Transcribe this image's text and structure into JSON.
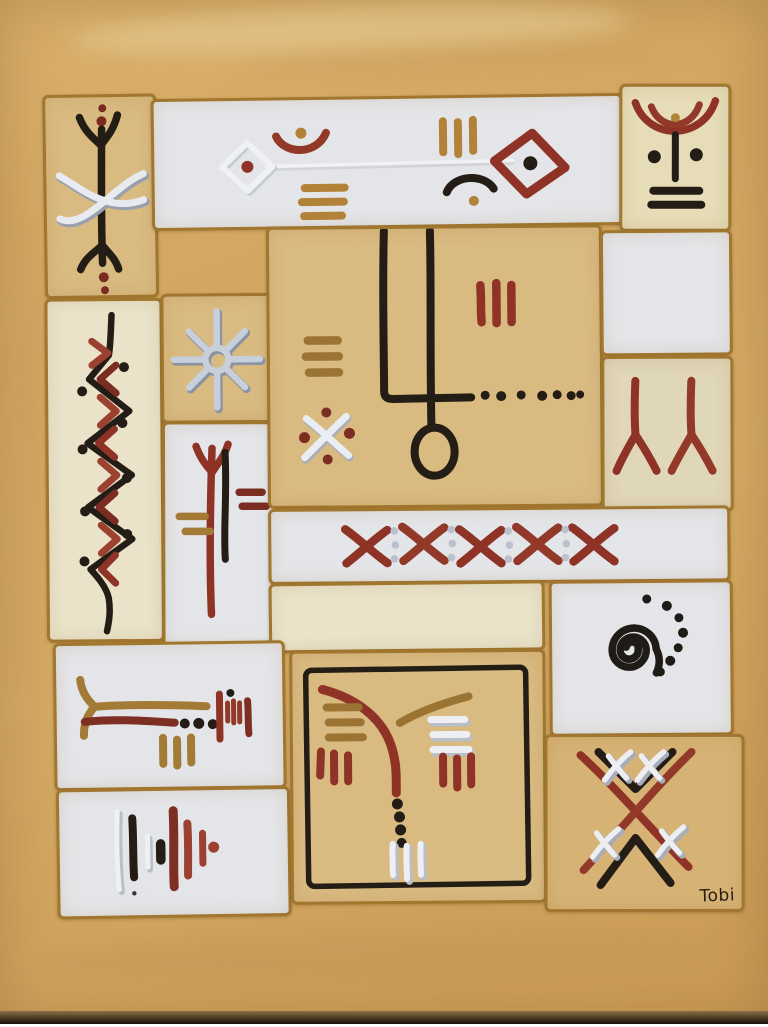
{
  "artwork": {
    "signature": "Tobi"
  },
  "palette": {
    "background_mustard": "#d3a761",
    "panel_tan": "#d9ba80",
    "panel_cream": "#eae3ca",
    "panel_cream_dark": "#e0d6b8",
    "panel_white": "#e4e5e8",
    "divider_ochre": "#a1762e",
    "symbol_black": "#241d16",
    "symbol_maroon": "#7c2d22",
    "symbol_red": "#8e3326",
    "symbol_ochre": "#a37a36",
    "symbol_silver": "#c3cad6",
    "symbol_white": "#eceef2"
  },
  "panels": [
    {
      "id": "top-left",
      "background": "tan",
      "symbols": [
        "dots-pair",
        "trident-up",
        "center-pole",
        "white-woven-cross",
        "trident-down",
        "dots-pair"
      ]
    },
    {
      "id": "top-banner",
      "background": "white",
      "symbols": [
        "embossed-line",
        "white-diamond-with-dot",
        "red-arc-with-dot",
        "ochre-dashes-x3",
        "ochre-bars-x3",
        "black-arc-with-dot",
        "red-diamond-with-dot"
      ]
    },
    {
      "id": "top-right",
      "background": "cream",
      "symbols": [
        "double-red-arcs",
        "ochre-dot",
        "pole-with-two-dots",
        "black-dashes-x2"
      ]
    },
    {
      "id": "left-zigzag",
      "background": "cream",
      "symbols": [
        "black-zigzag-line",
        "red-chevrons",
        "black-dots-x8"
      ]
    },
    {
      "id": "star",
      "background": "tan",
      "symbols": [
        "eight-ray-silver-star"
      ]
    },
    {
      "id": "red-trident",
      "background": "white",
      "symbols": [
        "red-trident-pole",
        "black-pole",
        "ochre-dashes-x2",
        "red-dashes-x2"
      ]
    },
    {
      "id": "center-hook",
      "background": "tan",
      "symbols": [
        "black-double-stem-loop",
        "black-dotted-line-x7",
        "red-bars-x3",
        "ochre-dashes-x3",
        "white-cross-with-red-dots"
      ]
    },
    {
      "id": "right-blank",
      "background": "white",
      "symbols": []
    },
    {
      "id": "double-y",
      "background": "cream-dark",
      "symbols": [
        "red-inverted-y",
        "red-inverted-y"
      ]
    },
    {
      "id": "x-row",
      "background": "white",
      "symbols": [
        "red-x",
        "silver-dots-x3",
        "red-x",
        "silver-dots-x3",
        "red-x",
        "silver-dots-x3",
        "red-x",
        "silver-dots-x3",
        "red-x"
      ]
    },
    {
      "id": "cream-blank",
      "background": "cream",
      "symbols": []
    },
    {
      "id": "spiral",
      "background": "white",
      "symbols": [
        "black-spiral",
        "black-dot-arc-x7"
      ]
    },
    {
      "id": "fork-line",
      "background": "white",
      "symbols": [
        "ochre-fork-line",
        "maroon-line-with-dots-x3",
        "red-bar-cluster",
        "ochre-bars-x3"
      ]
    },
    {
      "id": "bar-rhythm",
      "background": "white",
      "symbols": [
        "white-bar",
        "black-bar",
        "white-bar-short",
        "black-blob",
        "maroon-bar",
        "red-bar",
        "red-bar-short",
        "red-dot"
      ]
    },
    {
      "id": "bordered-square",
      "background": "tan",
      "symbols": [
        "black-square-border",
        "red-branch-with-dots-x4",
        "ochre-branch",
        "ochre-dashes-x3",
        "red-bars-x3",
        "white-dashes-x3",
        "red-bars-x3",
        "white-bars-x3"
      ]
    },
    {
      "id": "lattice",
      "background": "tan",
      "symbols": [
        "red-diagonal-cross",
        "black-chevron-down",
        "black-chevron-up",
        "white-stitch-x4",
        "signature"
      ]
    }
  ]
}
